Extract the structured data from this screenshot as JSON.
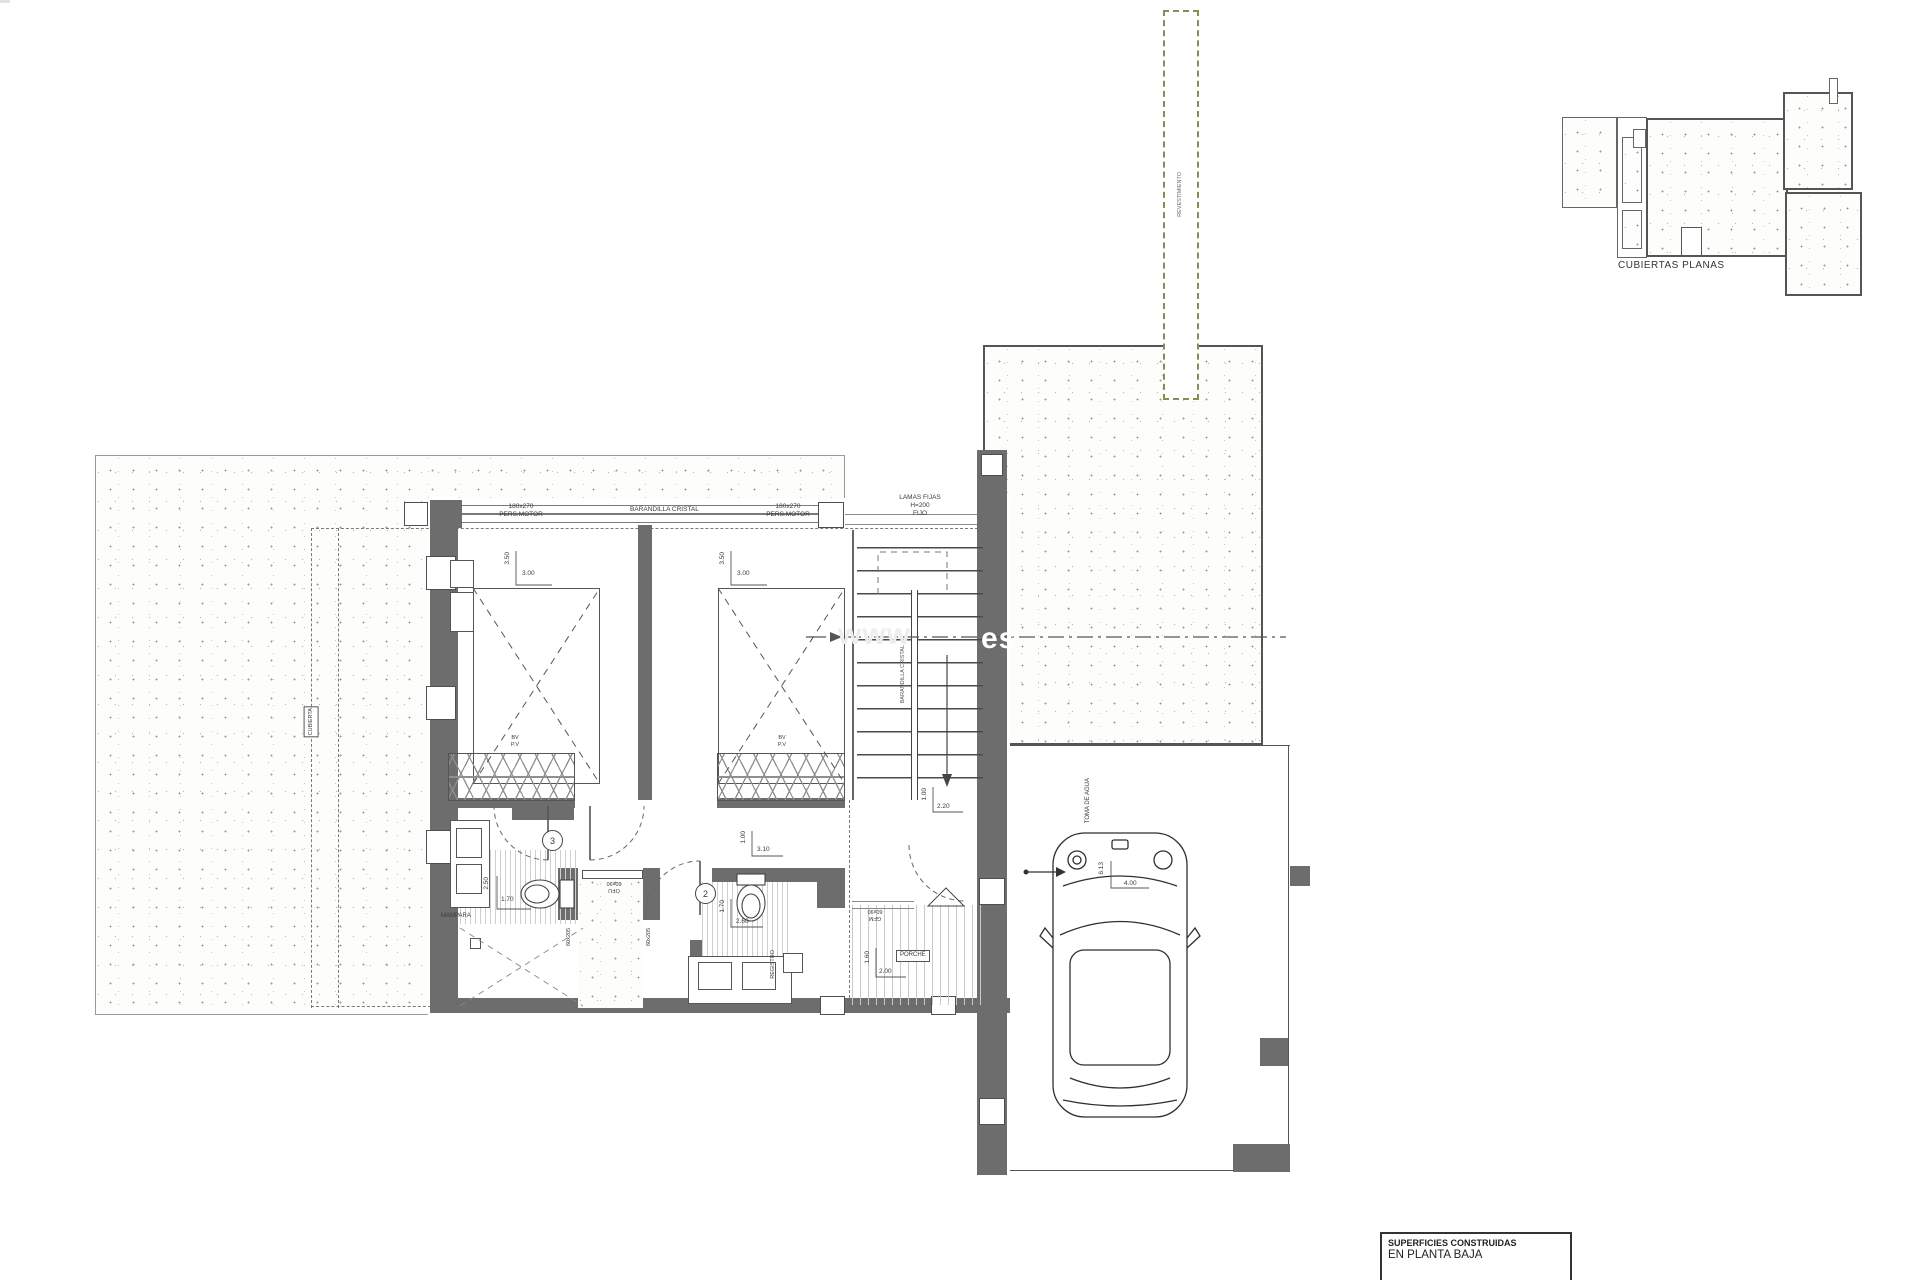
{
  "strip": {
    "label": "REVESTIMIENTO"
  },
  "inset": {
    "title": "CUBIERTAS PLANAS"
  },
  "top": {
    "pers_left_l1": "180x270",
    "pers_left_l2": "PERS.MOTOR",
    "glass_rail": "BARANDILLA CRISTAL",
    "pers_right_l1": "180x270",
    "pers_right_l2": "PERS.MOTOR",
    "lamas_l1": "LAMAS FIJAS",
    "lamas_l2": "H=200",
    "lamas_l3": "FIJO"
  },
  "bedroom1": {
    "dim_w": "3.00",
    "dim_h": "3.50",
    "wardrobe_l1": "BV",
    "wardrobe_l2": "P.V"
  },
  "bedroom2": {
    "dim_w": "3.00",
    "dim_h": "3.50",
    "wardrobe_l1": "BV",
    "wardrobe_l2": "P.V"
  },
  "bath3": {
    "num": "3",
    "dim_w": "1.70",
    "dim_h": "2.50",
    "screen": "MAMPARA"
  },
  "bath2": {
    "num": "2",
    "dim_w": "2.60",
    "dim_h": "1.70",
    "entry_dim_w": "3.10",
    "entry_dim_h": "1.00",
    "shaft_label": "REGISTRO"
  },
  "lightwell": {
    "win_l1": "OFU",
    "win_l2": "60x90",
    "side_left": "60x205",
    "side_right": "60x205"
  },
  "hall_step": {
    "l1": "GFM",
    "l2": "60x90"
  },
  "porch": {
    "name": "PORCHE",
    "dim_w": "2.00",
    "dim_h": "1.60"
  },
  "stairs": {
    "rail": "BARANDILLA CRISTAL",
    "dim_w": "2.20",
    "dim_h": "1.00"
  },
  "garage": {
    "water": "TOMA DE AGUA",
    "dim_w": "4.00",
    "dim_h": "6.13"
  },
  "terrace": {
    "edge_label": "CUBIERTA"
  },
  "watermark": {
    "prefix": "www",
    "suffix": "es"
  },
  "legend": {
    "l1": "SUPERFICIES CONSTRUIDAS",
    "l2": "EN PLANTA BAJA"
  },
  "colors": {
    "wall": "#6d6d6d",
    "cladding_dash": "#8b8b55",
    "line": "#555555"
  }
}
